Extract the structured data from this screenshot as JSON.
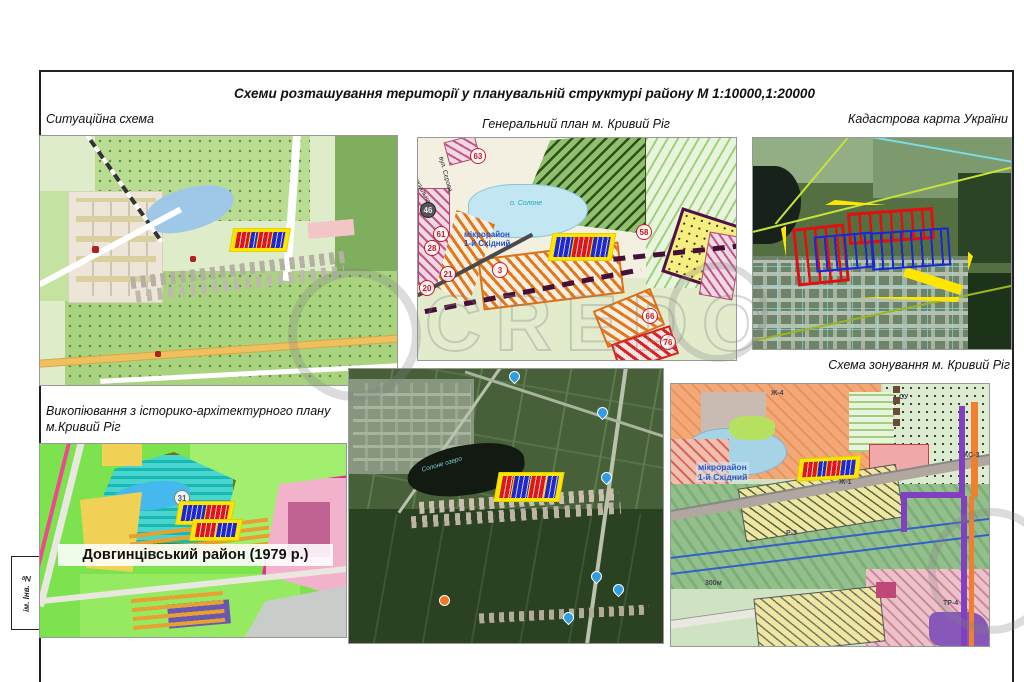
{
  "sheet": {
    "title": "Схеми розташування території у планувальній структурі  району  М 1:10000,1:20000",
    "stamp": "ім. Інв. №",
    "watermark": "CREDO"
  },
  "labels": {
    "situational": "Ситуаційна схема",
    "general_plan": "Генеральний план м. Кривий Ріг",
    "cadastral": "Кадастрова карта України",
    "zoning": "Схема зонування м. Кривий Ріг",
    "historical_1": "Викопіювання з історико-архітектурного плану",
    "historical_2": "м.Кривий Ріг"
  },
  "map_general": {
    "lake": "о. Солоне",
    "district_1": "мікрорайон",
    "district_2": "1-й Східний",
    "street_1": "ул. Вокзальная",
    "street_2": "вул. Сєрова",
    "badges": [
      "63",
      "61",
      "28",
      "21",
      "20",
      "3",
      "58",
      "66",
      "76"
    ],
    "badge_dark": "46"
  },
  "map_historical": {
    "caption": "Довгинцівський район (1979 р.)",
    "badge": "31"
  },
  "map_satellite": {
    "lake": "Солоне озеро"
  },
  "map_zoning": {
    "district_1": "мікрорайон",
    "district_2": "1-й Східний",
    "zones": [
      "Ж-4",
      "СУ",
      "Р-3",
      "КС-3",
      "Ж-1",
      "300м",
      "ТР-4"
    ]
  },
  "colors": {
    "plot_outline": "#ffe600",
    "plot_red": "#dd1717",
    "plot_blue": "#2028c8",
    "badge_red": "#c81828",
    "district_blue": "#2050c8"
  }
}
